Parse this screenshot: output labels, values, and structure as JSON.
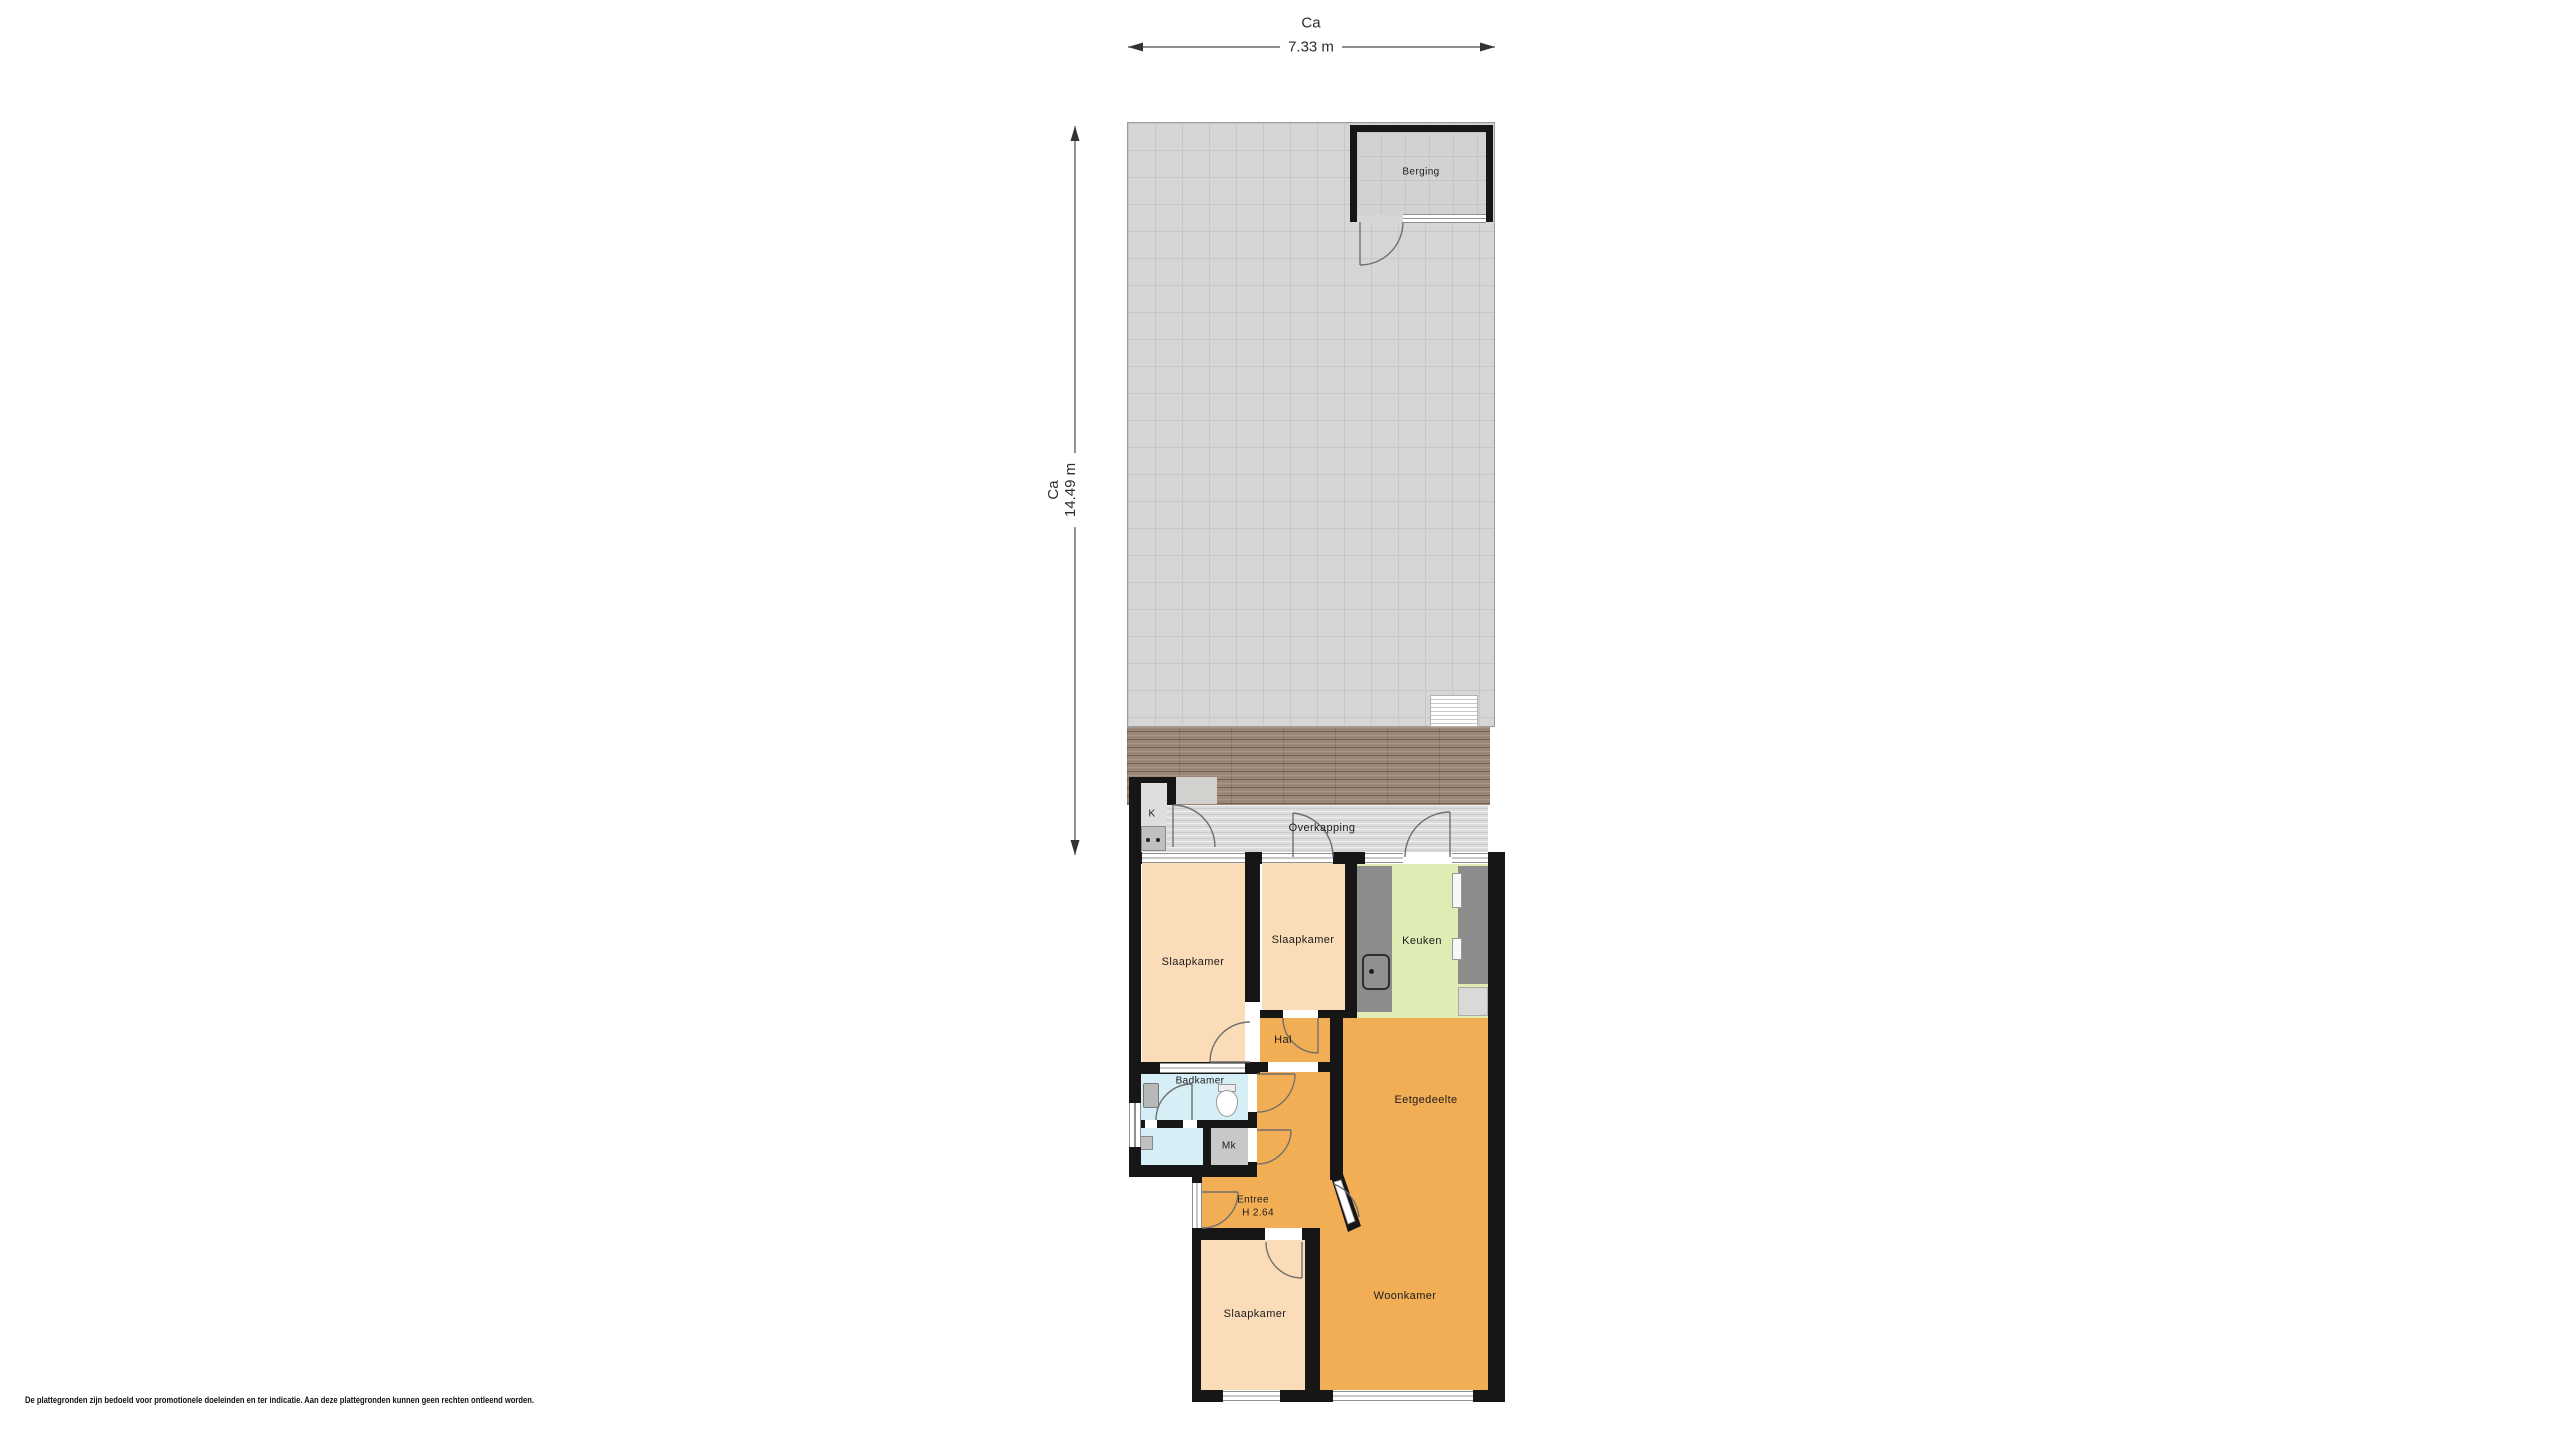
{
  "dimensions": {
    "width": {
      "prefix": "Ca",
      "value": "7.33 m"
    },
    "depth": {
      "prefix": "Ca",
      "value": "14.49 m"
    }
  },
  "rooms": {
    "berging": "Berging",
    "overkapping": "Overkapping",
    "k_closet": "K",
    "slaapkamer_left": "Slaapkamer",
    "slaapkamer_middle": "Slaapkamer",
    "keuken": "Keuken",
    "hal": "Hal",
    "badkamer": "Badkamer",
    "meterkast": "Mk",
    "entree": {
      "label": "Entree",
      "ceiling_height": "H 2.64"
    },
    "eetgedeelte": "Eetgedeelte",
    "woonkamer": "Woonkamer",
    "slaapkamer_bottom": "Slaapkamer"
  },
  "footer": {
    "disclaimer": "De plattegronden zijn bedoeld voor promotionele doeleinden en ter indicatie. Aan deze plattegronden kunnen geen rechten ontleend worden."
  },
  "colors": {
    "wall": "#161616",
    "bedroom_floor": "#fbdcb8",
    "living_floor": "#f2ae54",
    "kitchen_floor": "#dfecb4",
    "bathroom_floor": "#d6eef6",
    "garden_tiles": "#d6d6d6",
    "decking": "#9b8777",
    "storage_floor": "#d2d2d2",
    "counter": "#8c8c8c",
    "dimension_line": "#4a4a4a"
  }
}
